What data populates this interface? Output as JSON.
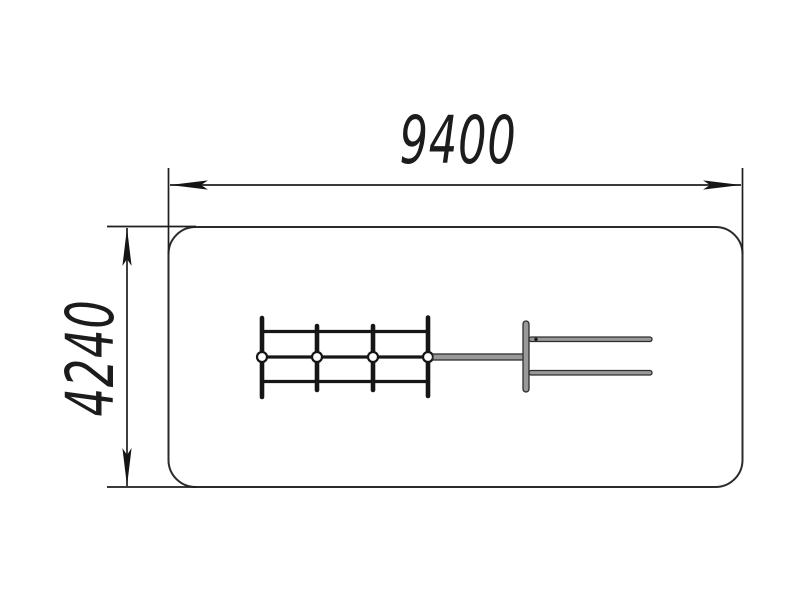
{
  "dimensions": {
    "width": {
      "label": "9400"
    },
    "height": {
      "label": "4240"
    }
  },
  "colors": {
    "line": "#1e1e1e",
    "arrow": "#151515",
    "boundary": "#2b2b2b",
    "structure": "#161616",
    "metal_fill": "#999999",
    "metal_stroke": "#2e2e2e",
    "joint_fill": "#ffffff",
    "background": "#ffffff"
  }
}
